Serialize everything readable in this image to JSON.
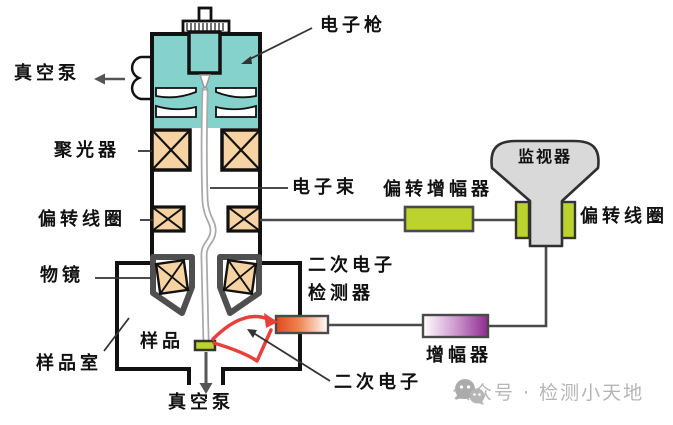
{
  "labels": {
    "electron_gun": "电子枪",
    "vacuum_pump_top": "真空泵",
    "condenser": "聚光器",
    "electron_beam": "电子束",
    "deflection_coil_left": "偏转线圈",
    "objective_lens": "物镜",
    "sample": "样品",
    "sample_chamber": "样品室",
    "vacuum_pump_bottom": "真空泵",
    "se_detector_line1": "二次电子",
    "se_detector_line2": "检测器",
    "secondary_electron": "二次电子",
    "deflection_amplifier": "偏转增幅器",
    "monitor": "监视器",
    "deflection_coil_right": "偏转线圈",
    "amplifier": "增幅器"
  },
  "watermark": {
    "text": "公众号 · 检测小天地"
  },
  "colors": {
    "column_teal": "#85d1cb",
    "lens_coil_fill": "#f7d2a3",
    "yellow_green": "#bcd32f",
    "monitor_gray": "#d9d9d9",
    "detector_orange": "#e2491b",
    "amplifier_purple": "#8e2a90",
    "secondary_electron_red": "#e8403a",
    "wire": "#4a4a4a",
    "outline": "#111111",
    "objective_gray": "#4f4f4f",
    "watermark_gray": "#b5b5b5"
  }
}
